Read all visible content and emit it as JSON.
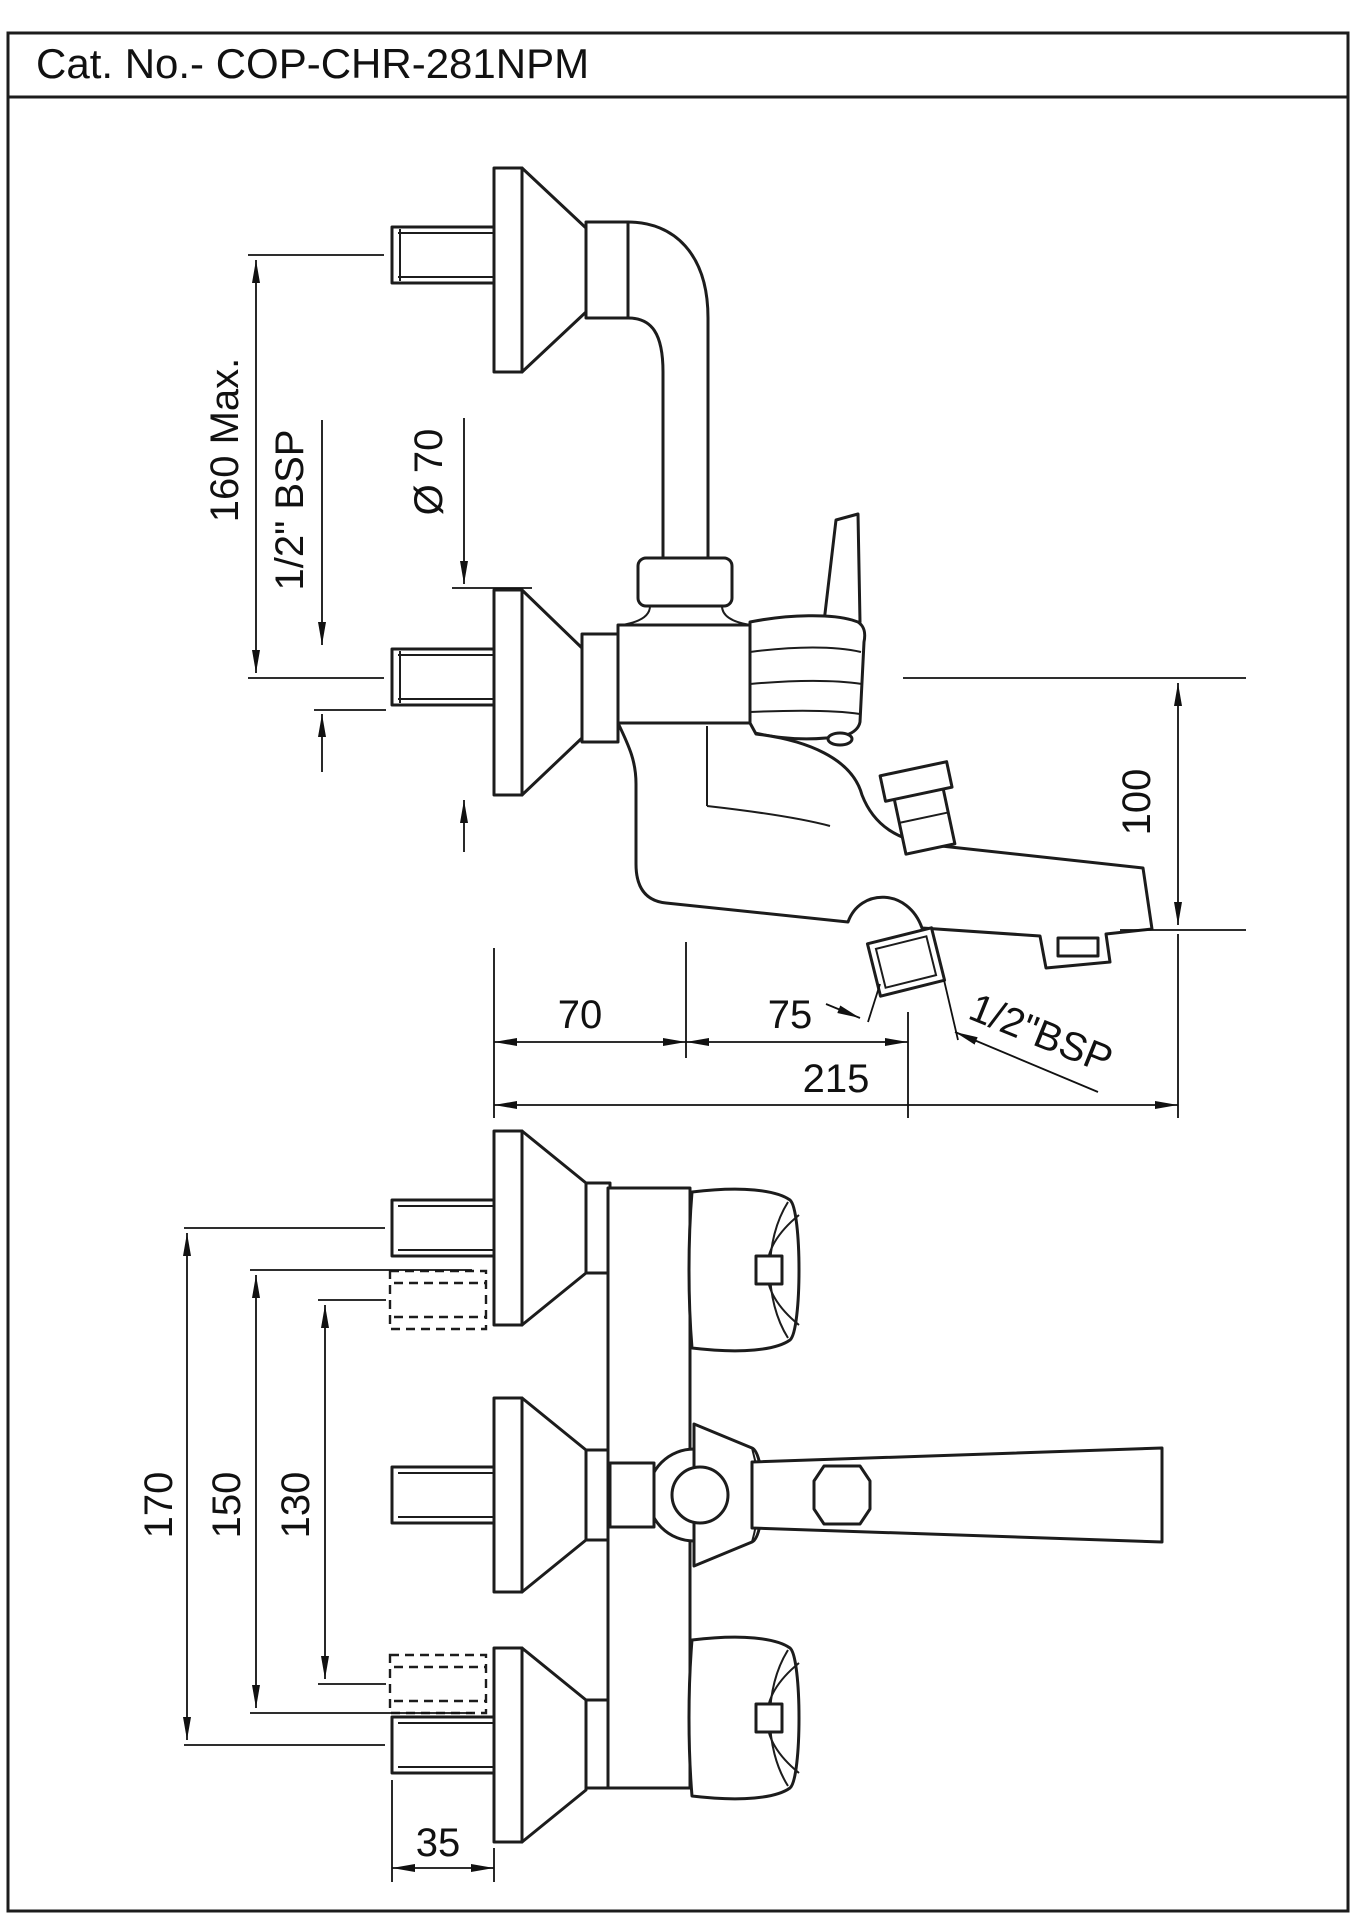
{
  "title_block": {
    "title": "Cat. No.- COP-CHR-281NPM"
  },
  "side_view": {
    "dimensions": {
      "inlet_spacing": "160 Max.",
      "inlet_thread": "1/2\" BSP",
      "flange_diameter": "Ø 70",
      "drop_height": "100",
      "wall_to_valve": "70",
      "valve_to_shower_outlet": "75",
      "overall_reach": "215",
      "shower_outlet_thread": "1/2\"BSP"
    }
  },
  "plan_view": {
    "dimensions": {
      "overall_span": "170",
      "mid_span": "150",
      "inner_span": "130",
      "nipple_length": "35"
    }
  }
}
